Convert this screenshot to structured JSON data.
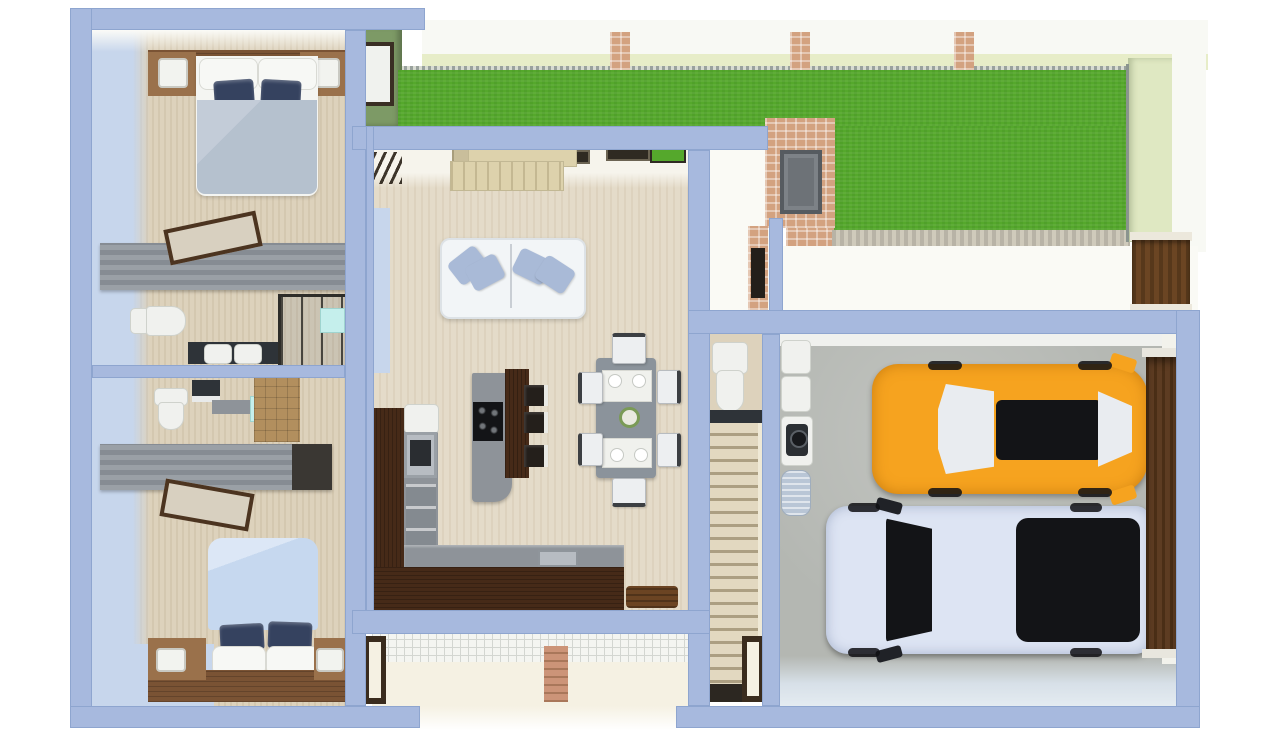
{
  "title": "house-floor-plan-3d-render",
  "palette": {
    "wall": "#a7b9de",
    "wallEdge": "#8ea5cf",
    "floor": "#ddd2bc",
    "floorLiving": "#e4dbc9",
    "face": "#c7d6ec",
    "grass": "#55a82c",
    "greenWall": "#7d9a66",
    "fenceWhite": "#f8f9f4",
    "fencePale": "#e7edc8",
    "paleFaceR": "#dfe8c2",
    "speckle": "#9aa29d",
    "walk": "#fafaf5",
    "concrete": "#b4b7b2",
    "apron": "#d7e0e8",
    "ivory": "#f5f1e3",
    "tile": "#f4f5f1",
    "tileLine": "#d3d6d1",
    "woodDark": "#462a18",
    "woodMid": "#7a5334",
    "woodLight": "#9a714b",
    "counter": "#8e9399",
    "closetDark": "#3a3733",
    "navy": "#35425f",
    "blanket1": "#b5c1ce",
    "blanket2": "#c6d8ef",
    "sofa": "#f2f5f7",
    "pillow": "#a9bad7",
    "whiteObj": "#f0f1ee",
    "dark": "#2e3338",
    "black": "#131417",
    "orange": "#f6a31f",
    "truck": "#dde4f3",
    "glass": "#e9ecf0",
    "brick": "#d3a280",
    "brickTrim": "#b8b3a6",
    "gate": "#6b4523",
    "garageDoor": "#5d3c22",
    "stairs": "#e2d8c0",
    "stairsLine": "#ac9f82",
    "mint": "#c5efec",
    "cork": "#b28f5e",
    "table": "#8b939b",
    "chair": "#edeff1",
    "bowlGreen": "#7a9a56",
    "mat": "#6b4423",
    "stainless": "#b7bcc2",
    "cylinder": "#b9c6d6",
    "cream": "#ddd2ac"
  },
  "scene": {
    "type": "3d-top-down-floor-plan",
    "rooms": [
      {
        "id": "bedroom-top",
        "furniture": [
          "double-bed",
          "nightstand-left",
          "nightstand-right",
          "headboard-shelf",
          "wardrobe"
        ]
      },
      {
        "id": "bathroom-1",
        "furniture": [
          "toilet",
          "double-sink-vanity",
          "shower"
        ]
      },
      {
        "id": "bathroom-2",
        "furniture": [
          "toilet",
          "vanity",
          "glass-panel",
          "cork-wall"
        ]
      },
      {
        "id": "bedroom-bottom",
        "furniture": [
          "double-bed",
          "nightstand-left",
          "nightstand-right",
          "headboard-shelf",
          "wardrobe"
        ]
      },
      {
        "id": "living-room",
        "furniture": [
          "sofa",
          "sideboard-ac-unit",
          "fireplace-chimney",
          "dining-table",
          "dining-chairs-x6"
        ]
      },
      {
        "id": "kitchen",
        "furniture": [
          "l-shaped-counter",
          "island-with-cooktop",
          "bar-stools-x3",
          "oven",
          "sink",
          "door-mat"
        ]
      },
      {
        "id": "hallway",
        "furniture": [
          "powder-toilet",
          "staircase"
        ]
      },
      {
        "id": "garage",
        "furniture": [
          "washer",
          "dryer",
          "water-tank",
          "garage-door"
        ]
      },
      {
        "id": "yard",
        "furniture": [
          "lawn",
          "fence",
          "brick-posts",
          "wooden-gate",
          "walkway"
        ]
      },
      {
        "id": "porch",
        "furniture": [
          "tile-band",
          "brick-path",
          "door-frames"
        ]
      }
    ],
    "vehicles": [
      {
        "id": "orange-suv",
        "color_key": "orange"
      },
      {
        "id": "white-pickup-truck",
        "color_key": "truck"
      }
    ]
  }
}
